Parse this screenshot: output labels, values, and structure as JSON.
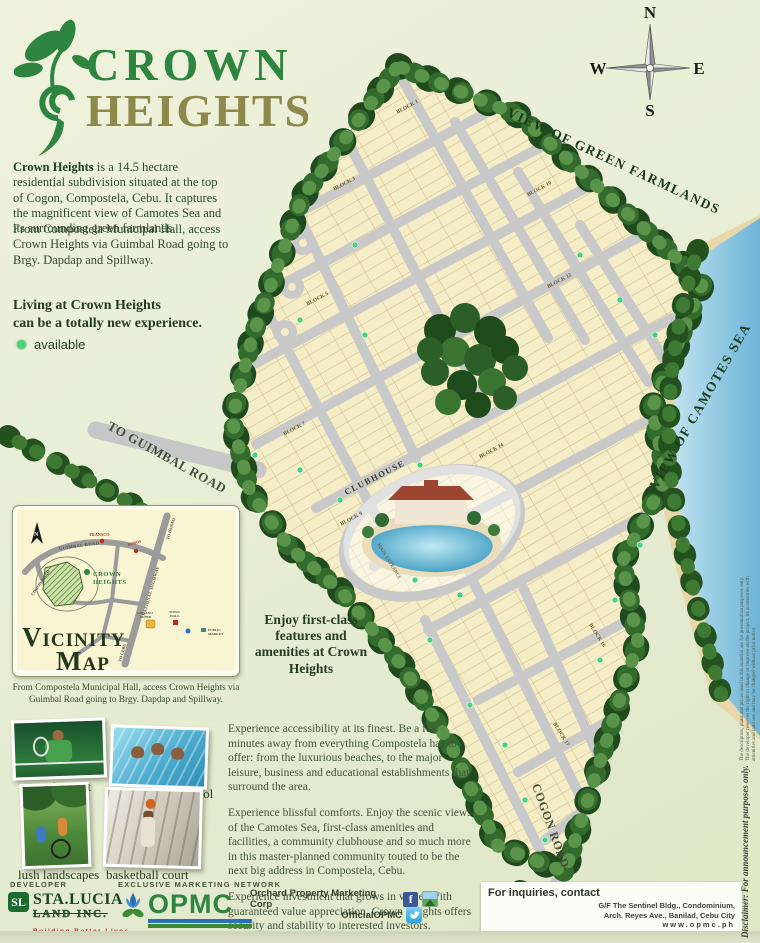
{
  "logo": {
    "line1": "CROWN",
    "line2": "HEIGHTS"
  },
  "intro": {
    "lead": "Crown Heights",
    "p1_rest": " is a 14.5 hectare residential subdivision situated at the top of Cogon, Compostela, Cebu. It captures the magnificent view of Camotes Sea and its surrounding green farmlands.",
    "p2": "From Compostela Municipal Hall, access Crown Heights via Guimbal Road going to Brgy. Dapdap and Spillway."
  },
  "tagline_line1": "Living at Crown Heights",
  "tagline_line2": "can be a totally new experience.",
  "legend": {
    "available": "available",
    "available_color": "#49d37d"
  },
  "compass": {
    "n": "N",
    "e": "E",
    "s": "S",
    "w": "W"
  },
  "site_map": {
    "view_farmlands": "VIEW OF GREEN FARMLANDS",
    "view_sea": "VIEW OF CAMOTES SEA",
    "to_guimbal": "TO GUIMBAL ROAD",
    "cogon_road": "COGON ROAD",
    "clubhouse": "CLUBHOUSE",
    "main_entrance": "MAIN ENTRANCE",
    "blocks": [
      "BLOCK 1",
      "BLOCK 3",
      "BLOCK 5",
      "BLOCK 7",
      "BLOCK 9",
      "BLOCK 10",
      "BLOCK 12",
      "BLOCK 14",
      "BLOCK 16",
      "BLOCK 17"
    ]
  },
  "vicinity": {
    "title1": "Vicinity",
    "title2": "Map",
    "labels": {
      "north": "N",
      "guimbal": "GUIMBAL ROAD",
      "cogon": "COGON ROAD",
      "highway": "NATIONAL HIGHWAY",
      "to_danao": "TO DANAO",
      "to_cebu": "TO CEBU",
      "transco": "TRANSCO",
      "robos": "ROBOS",
      "supermarket1": "GAISANO",
      "supermarket2": "SUPER",
      "town1": "TOWN",
      "town2": "HALL",
      "pm1": "PUBLIC",
      "pm2": "MARKET",
      "crown1": "CROWN",
      "crown2": "HEIGHTS"
    },
    "caption": "From Compostela Municipal Hall, access Crown Heights via Guimbal Road going to Brgy. Dapdap and Spillway."
  },
  "amenities_heading": "Enjoy first-class features and amenities at Crown Heights",
  "photos": {
    "tennis": "tennis court",
    "pool": "swimming pool",
    "landscape": "lush landscapes",
    "basketball": "basketball court"
  },
  "body": {
    "p1": "Experience accessibility at its finest. Be a few minutes away from everything Compostela has to offer: from the luxurious beaches, to the major leisure, business and educational establishments that surround the area.",
    "p2": "Experience blissful comforts. Enjoy the scenic views of the Camotes Sea, first-class amenities and facilities, a community clubhouse and so much more in this master-planned community touted to be the next big address in Compostela, Cebu.",
    "p3": "Experience investment that grows in value. With guaranteed value appreciation, Crown Heights offers security and stability to interested investors.",
    "p4": "Get this new lifestyle experience now."
  },
  "developer": {
    "heading": "DEVELOPER",
    "mark": "SL",
    "brand_top": "STA.LUCIA",
    "brand_bottom": "LAND INC.",
    "tagline": "Building Better Lives."
  },
  "marketing": {
    "heading": "EXCLUSIVE MARKETING NETWORK",
    "brand": "OPMC"
  },
  "social": {
    "facebook": "Orchard Property Marketing Corp",
    "facebook_glyph": "f",
    "twitter": "OfficialOPMC"
  },
  "inquiries": {
    "heading": "For inquiries, contact",
    "address1": "G/F The Sentinel Bldg., Condominium,",
    "address2": "Arch. Reyes Ave., Banilad, Cebu City",
    "website": "www.opmc.ph"
  },
  "disclaimer": {
    "title": "Disclaimer: For announcement purposes only.",
    "body": "The descriptors, plans and prices used in this material are for presentation purposes only. The developer reserves the right to change or improve on the project, its accessories with amenities and land use and may be changed without prior notice."
  }
}
